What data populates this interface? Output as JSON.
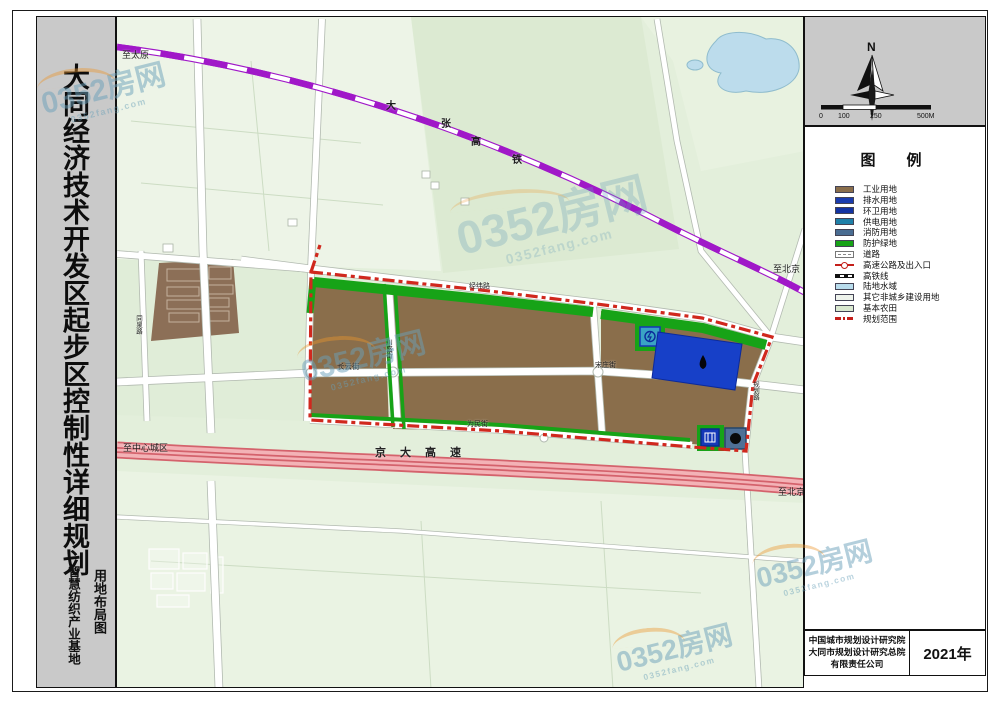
{
  "title_bar": {
    "main_title": "大同经济技术开发区起步区控制性详细规划",
    "subtitle": "智慧纺织产业基地",
    "map_type": "用地布局图"
  },
  "compass": {
    "label": "N"
  },
  "scale_bar": {
    "ticks": [
      "0",
      "100",
      "250",
      "500M"
    ]
  },
  "legend": {
    "title": "图　例",
    "items": [
      {
        "label": "工业用地",
        "type": "fill",
        "color": "#8a6e4b"
      },
      {
        "label": "排水用地",
        "type": "fill",
        "color": "#1a3cae"
      },
      {
        "label": "环卫用地",
        "type": "fill",
        "color": "#1333a2"
      },
      {
        "label": "供电用地",
        "type": "fill",
        "color": "#1f80a8"
      },
      {
        "label": "消防用地",
        "type": "fill",
        "color": "#4a6d92"
      },
      {
        "label": "防护绿地",
        "type": "fill",
        "color": "#17a317"
      },
      {
        "label": "道路",
        "type": "road"
      },
      {
        "label": "高速公路及出入口",
        "type": "highway"
      },
      {
        "label": "高铁线",
        "type": "rail"
      },
      {
        "label": "陆地水域",
        "type": "fill",
        "color": "#b8dcec"
      },
      {
        "label": "其它非城乡建设用地",
        "type": "fill",
        "color": "#eef3ec"
      },
      {
        "label": "基本农田",
        "type": "fill",
        "color": "#d9e8cf"
      },
      {
        "label": "规划范围",
        "type": "dashdot"
      }
    ]
  },
  "credits": {
    "org_lines": [
      "中国城市规划设计研究院",
      "大同市规划设计研究总院",
      "有限责任公司"
    ],
    "year": "2021年"
  },
  "map": {
    "labels": {
      "to_taiyuan": "至太原",
      "railway_name": [
        "大",
        "张",
        "高",
        "铁"
      ],
      "to_beijing_rail": "至北京",
      "road_jingwei": "经纬路",
      "road_changyun": "长云街",
      "road_chuansheng": "川盛街",
      "road_songzhuang": "宋庄街",
      "road_weimin": "为民街",
      "road_tongquan": "同泉路",
      "road_guihua": "规划路",
      "highway_name": "京大高速",
      "to_city_center": "至中心城区",
      "to_beijing_hwy": "至北京"
    },
    "colors": {
      "farmland": "#e3efdb",
      "industrial": "#8a6e4b",
      "drainage": "#1740c8",
      "power": "#3aa3c4",
      "sanitation": "#1438b8",
      "fire": "#4f7096",
      "green_buffer": "#17a317",
      "boundary_red": "#d0281e",
      "railway_purple": "#a018c8",
      "highway_pink": "#f3b2b6",
      "water": "#bcdcec"
    }
  },
  "watermark": {
    "text": "0352房网",
    "domain": "0352fang.com"
  }
}
